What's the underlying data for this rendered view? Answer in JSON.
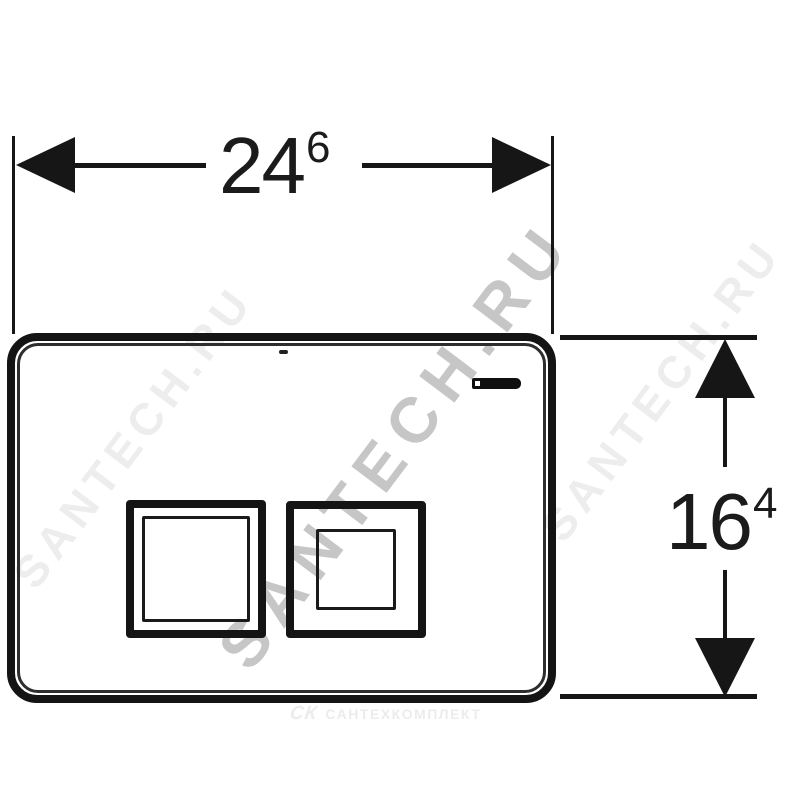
{
  "drawing": {
    "background_color": "#ffffff",
    "line_color": "#161616",
    "width_dimension": {
      "value": "24",
      "superscript": "6"
    },
    "height_dimension": {
      "value": "16",
      "superscript": "4"
    }
  },
  "plate": {
    "brand_logo_icon": "geberit-logo",
    "buttons": [
      "large-flush-button",
      "small-flush-button"
    ]
  },
  "watermarks": {
    "diagonal_text": "SANTECH.RU",
    "bottom_mark": "СК",
    "bottom_text": "САНТЕХКОМПЛЕКТ",
    "diagonal_main_color": "#c6c6c6",
    "diagonal_faint_color": "#ededed",
    "bottom_color": "#ececec"
  }
}
